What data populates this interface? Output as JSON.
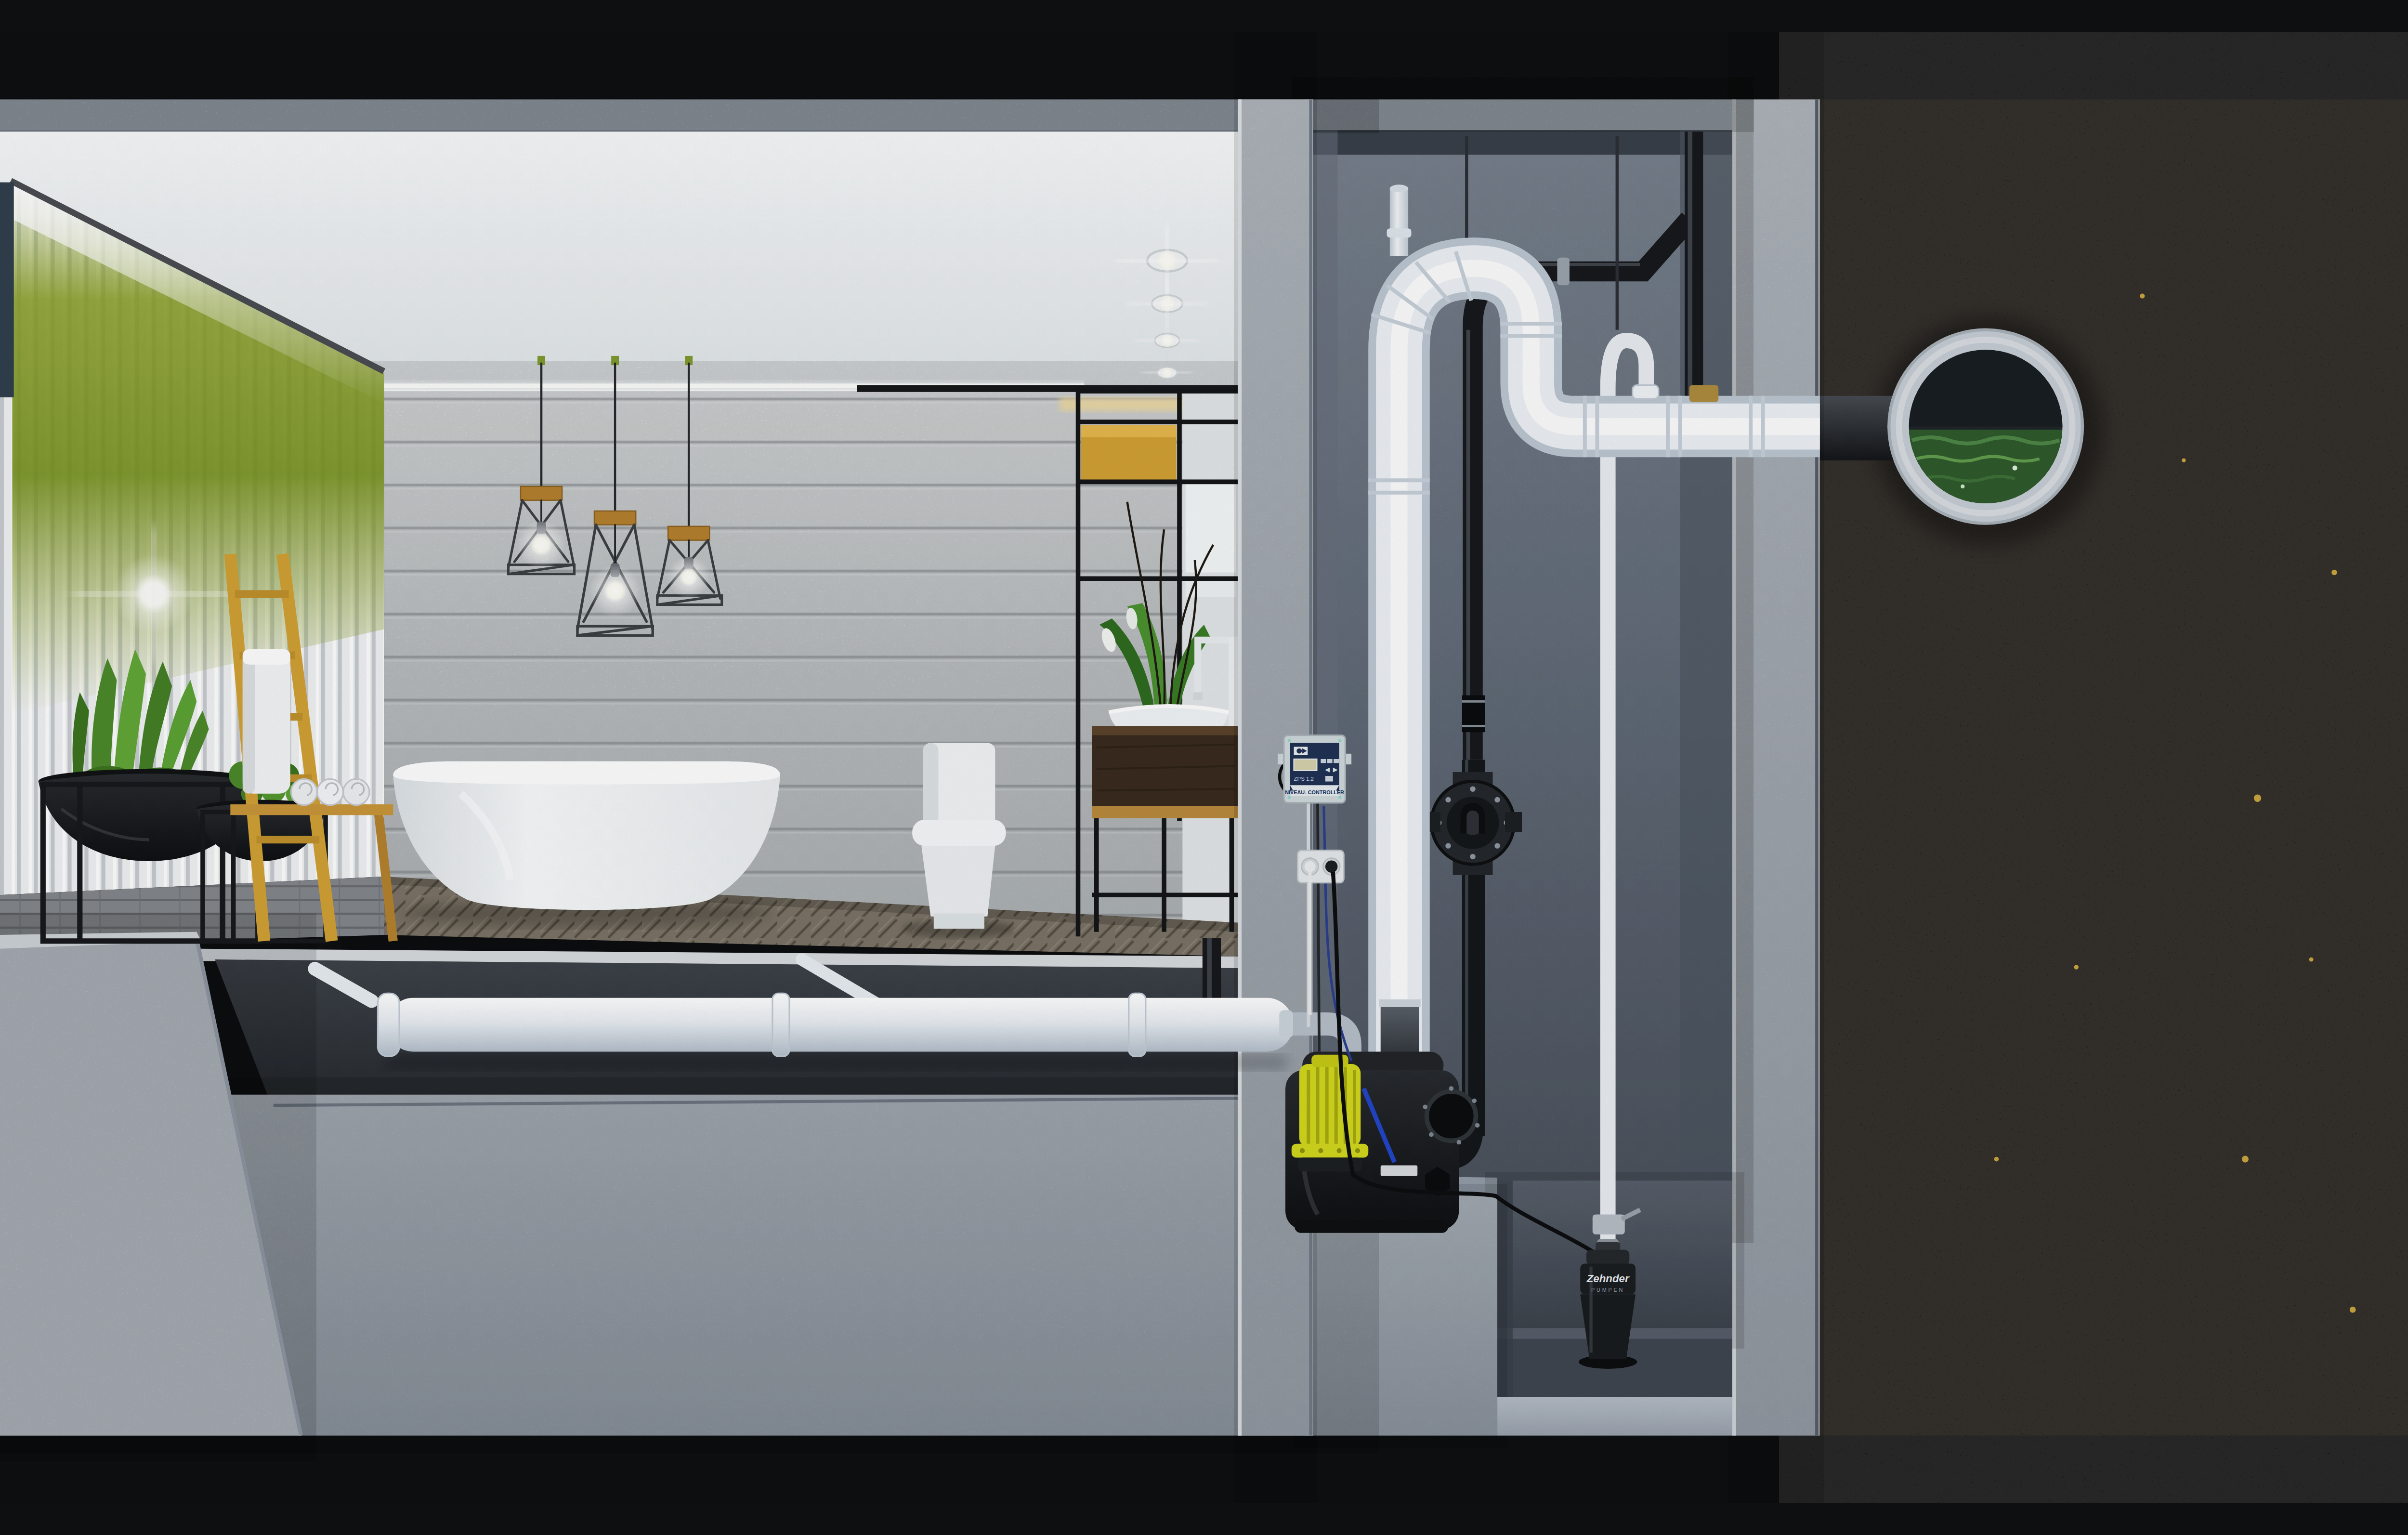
{
  "texts": {
    "controller_title": "NIVEAU- CONTROLLER",
    "controller_model": "ZPS 1.2",
    "pump_brand": "Zehnder",
    "pump_brand_sub": "PUMPEN"
  },
  "icons": {
    "controller_prev": "\u25c0",
    "controller_next": "\u25b6"
  },
  "colors": {
    "ceiling_white": "#eef1f3",
    "concrete_wall": "#cdd1d3",
    "cut_concrete": "#b7bfc8",
    "shaft_concrete": "#7e8a99",
    "soil_dark": "#2a2016",
    "soil_glint": "#c9a43f",
    "sewer_water_green": "#2f5c2c",
    "pipe_white": "#eef2f6",
    "pipe_black": "#17191c",
    "pump_yellow": "#d3d71d",
    "tank_black": "#1b1e21",
    "controller_navy": "#1f3154",
    "controller_body": "#cfd8dc",
    "lcd_beige": "#d6d2ae",
    "wood_oak": "#d2a135",
    "wood_dark": "#3a2b1e",
    "accent_green_wall": "#7d8f21",
    "plant_green": "#4e8f2c",
    "towel_white": "#f3f5f6",
    "floor_wood": "#7b7366",
    "deck_grey": "#84878b"
  }
}
